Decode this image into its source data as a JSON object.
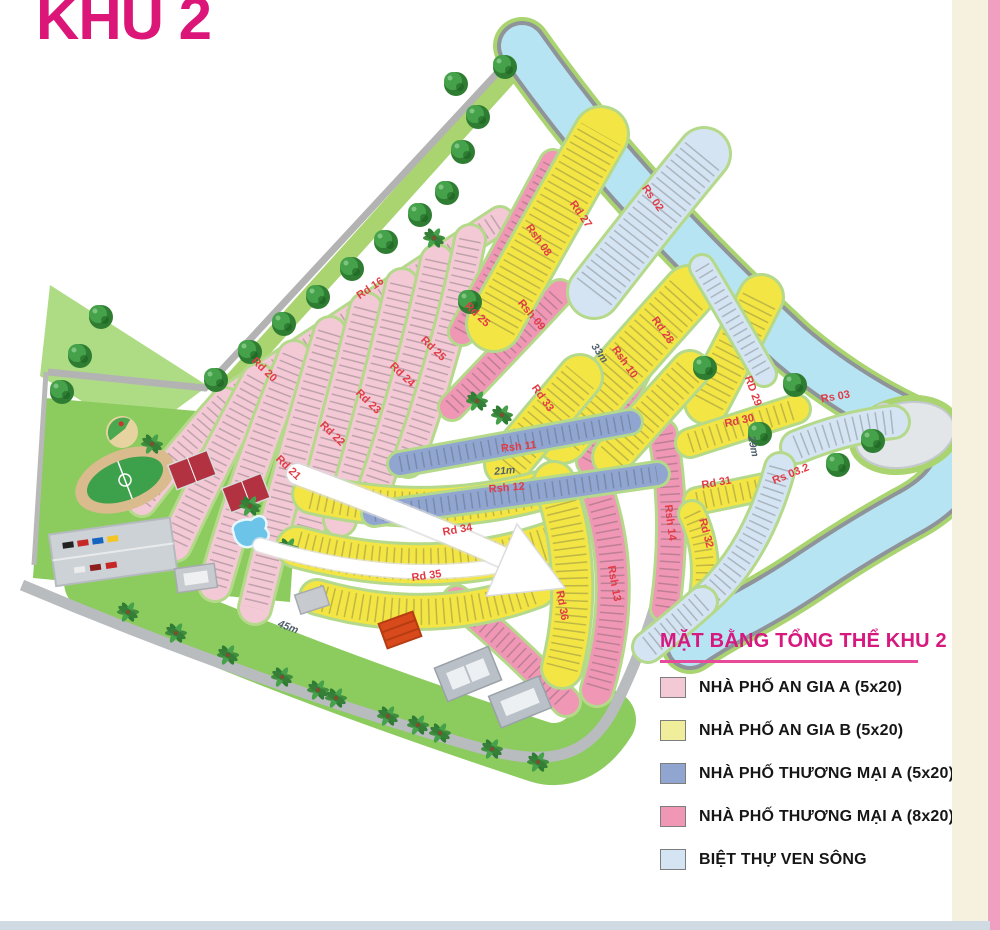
{
  "title": "KHU 2",
  "legend": {
    "title": "MẶT BẰNG TỔNG THỂ KHU 2",
    "items": [
      {
        "label": "NHÀ PHỐ AN GIA A (5x20)",
        "color": "#f3c9d6"
      },
      {
        "label": "NHÀ PHỐ AN GIA B (5x20)",
        "color": "#f0ee9a"
      },
      {
        "label": "NHÀ PHỐ THƯƠNG MẠI A (5x20)",
        "color": "#90a6d1"
      },
      {
        "label": "NHÀ PHỐ THƯƠNG MẠI A (8x20)",
        "color": "#ef97b5"
      },
      {
        "label": "BIỆT THỰ VEN SÔNG",
        "color": "#d4e4f2"
      }
    ]
  },
  "map": {
    "roads": {
      "rd16": "Rd 16",
      "rd20": "Rd 20",
      "rd21": "Rd 21",
      "rd22": "Rd 22",
      "rd23": "Rd 23",
      "rd24": "Rd 24",
      "rd25": "Rd 25",
      "rd27": "Rd 27",
      "rd28": "Rd 28",
      "rd29": "RD 29",
      "rd30": "Rd 30",
      "rd31": "Rd 31",
      "rd32": "Rd 32",
      "rd33": "Rd 33",
      "rd34": "Rd 34",
      "rd35": "Rd 35",
      "rd36": "Rd 36"
    },
    "riverside": {
      "rs02": "Rs 02",
      "rs03": "Rs 03",
      "rs03_2": "Rs 03.2"
    },
    "shophouse": {
      "rsh08": "Rsh 08",
      "rsh09": "Rsh 09",
      "rsh10": "Rsh 10",
      "rsh11": "Rsh 11",
      "rsh12": "Rsh 12",
      "rsh13": "Rsh 13",
      "rsh14": "Rsh 14"
    },
    "dimensions": {
      "d33": "33m",
      "d21": "21m",
      "d29": "29m",
      "d45": "45m"
    },
    "lot_numbers_visible": {
      "rs02": "10–21",
      "rsh13": "1–21",
      "rsh14": "1–9",
      "rd36_column": "21–46"
    }
  }
}
